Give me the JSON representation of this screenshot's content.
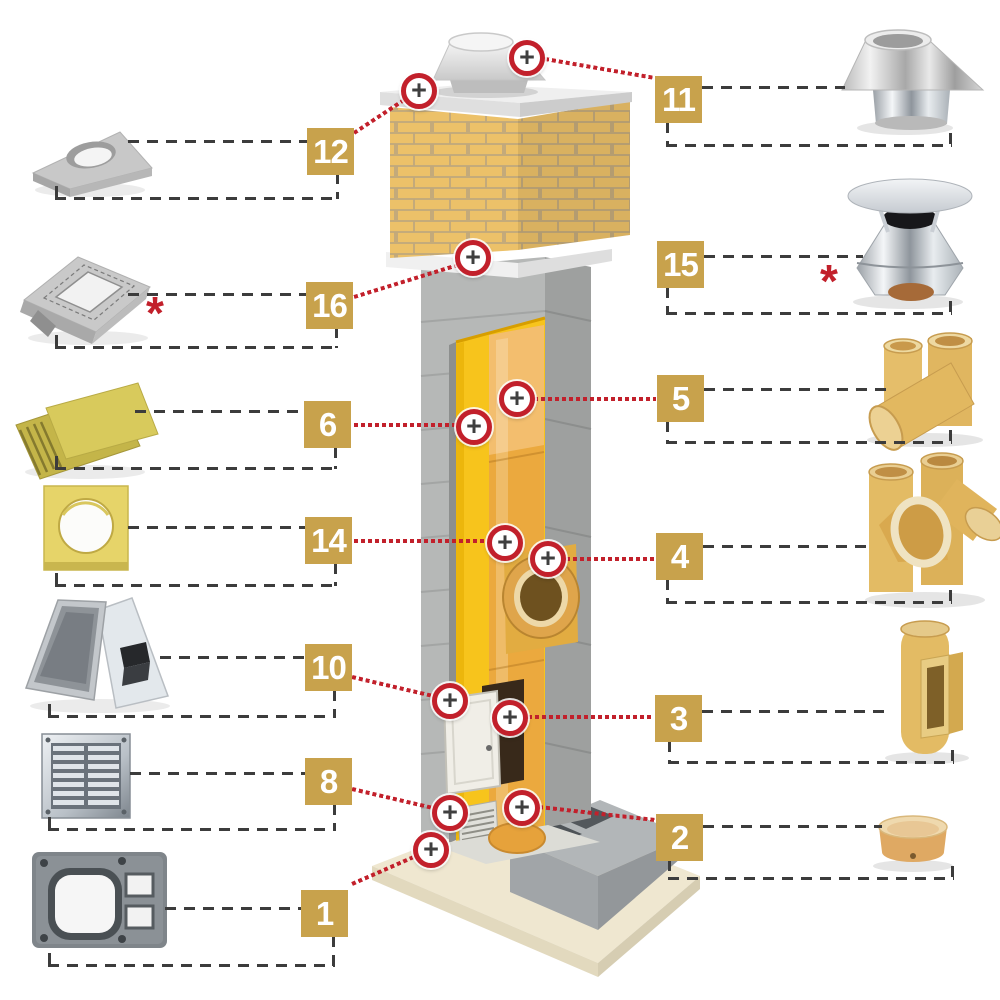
{
  "diagram": {
    "title": "Chimney system components diagram"
  },
  "colors": {
    "accent_gold": "#c8a24c",
    "accent_red": "#c2202b",
    "dash_gray": "#3c3c3c",
    "brick_tan": "#ecc169",
    "insulation_yellow": "#f7c41c",
    "ceramic_orange": "#eba93e"
  },
  "icons": {
    "plus_marker": "+",
    "asterisk": "*"
  },
  "labels": {
    "l1": "1",
    "l2": "2",
    "l3": "3",
    "l4": "4",
    "l5": "5",
    "l6": "6",
    "l8": "8",
    "l10": "10",
    "l11": "11",
    "l12": "12",
    "l14": "14",
    "l15": "15",
    "l16": "16"
  }
}
